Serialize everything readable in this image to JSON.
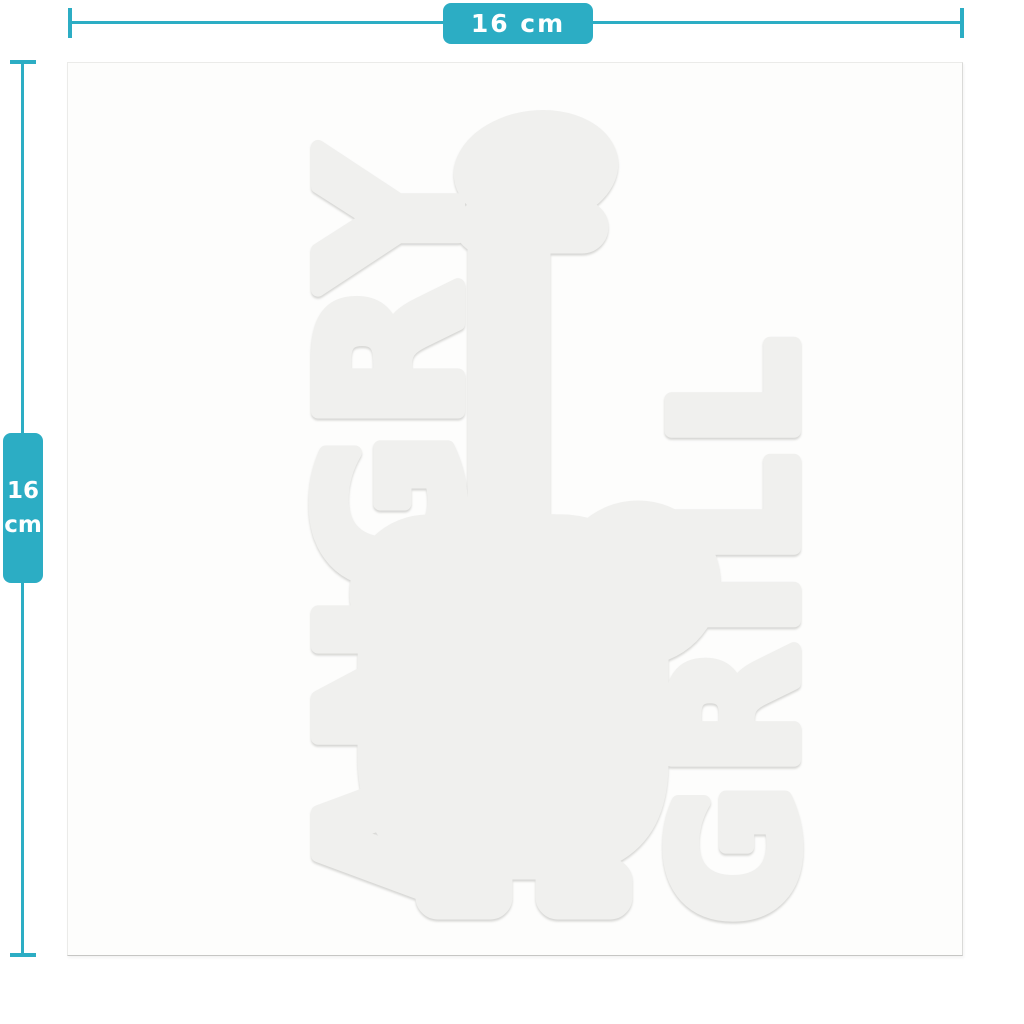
{
  "page": {
    "background": "#ffffff"
  },
  "colors": {
    "accent_teal": "#2cadc4",
    "sheet_background": "#fdfdfc",
    "silhouette": "#f0f0ee",
    "dimension_text": "#ffffff"
  },
  "dimension_width": {
    "label": "16 cm"
  },
  "dimension_height": {
    "value": "16",
    "unit": "cm"
  },
  "design": {
    "left_word": "ANGRY",
    "right_word": "GRILL",
    "figure": "capped-figure-silhouette",
    "color": "#f0f0ee"
  }
}
